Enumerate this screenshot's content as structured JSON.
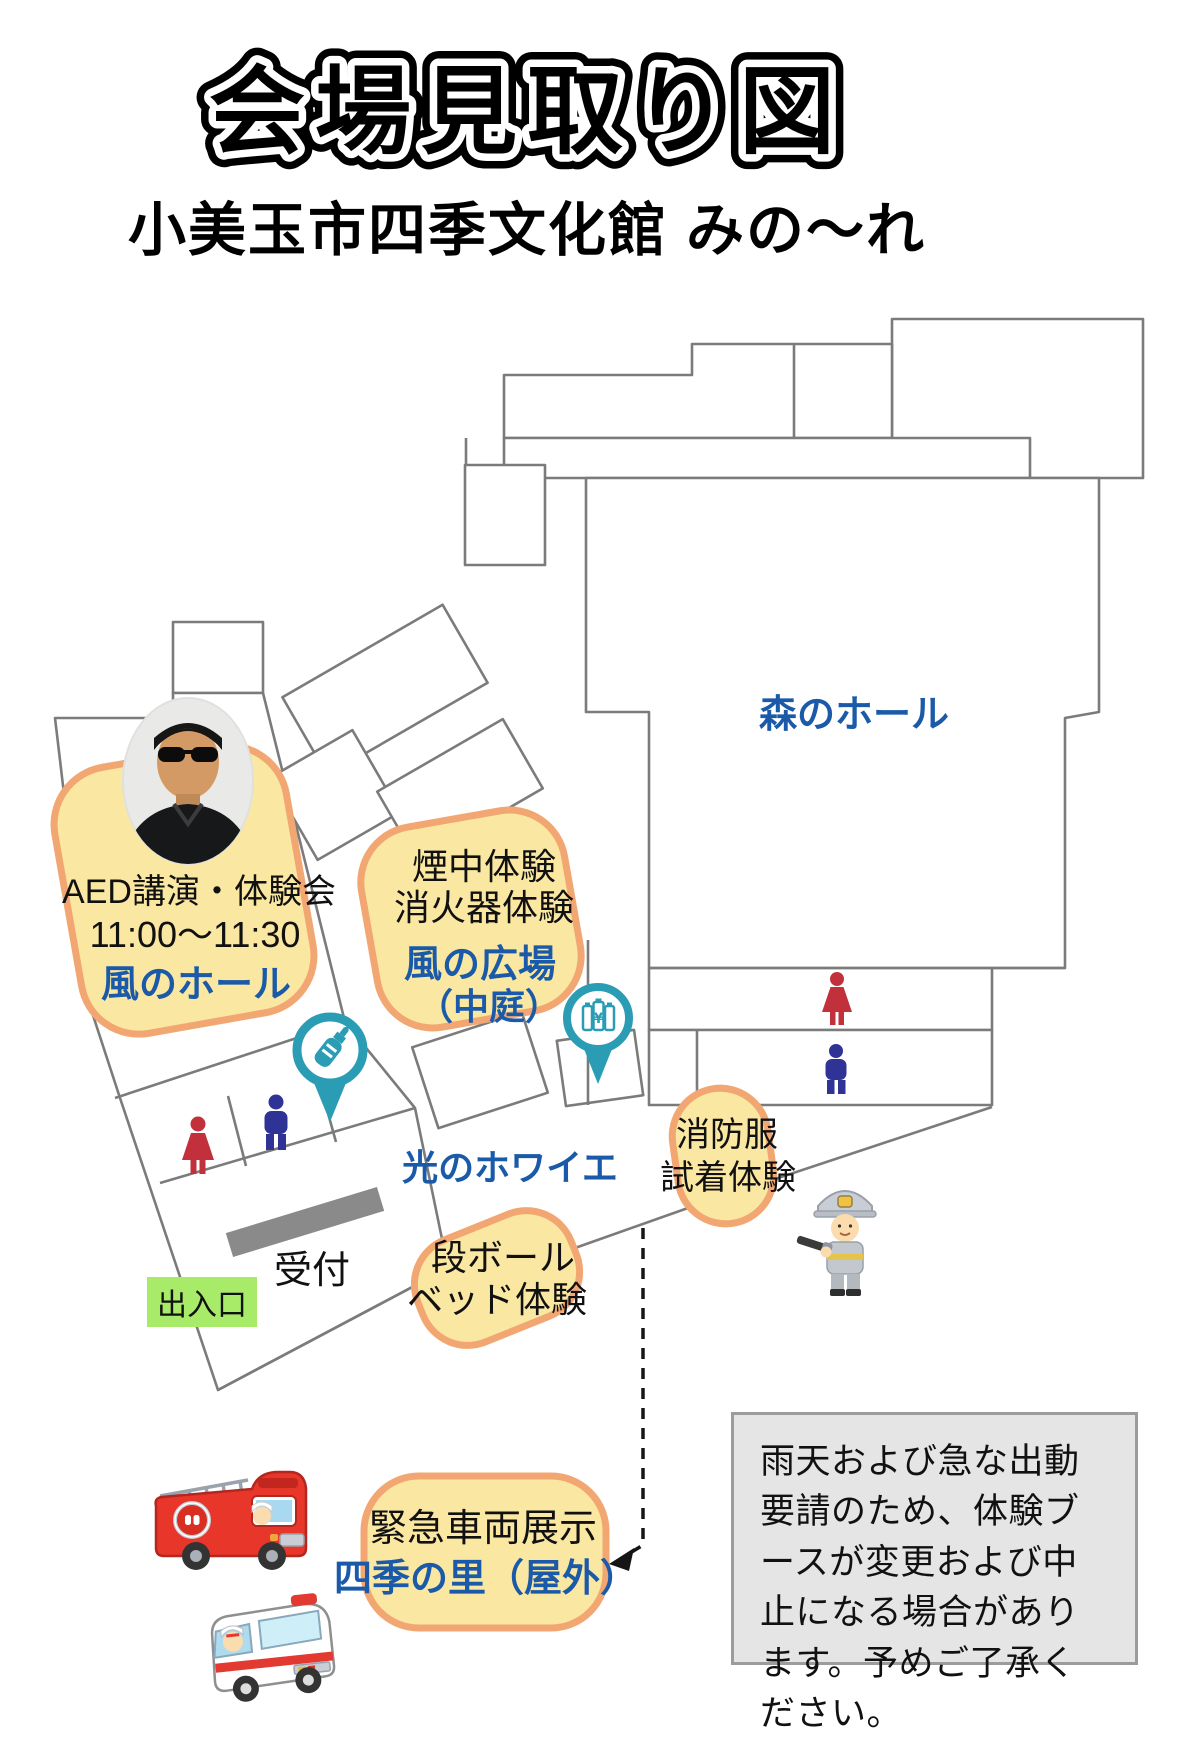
{
  "page": {
    "title": "会場見取り図",
    "subtitle": "小美玉市四季文化館 みの〜れ"
  },
  "map": {
    "forest_hall": "森のホール",
    "foyer": "光のホワイエ",
    "reception": "受付",
    "entrance": "出入口",
    "aed": {
      "line1": "AED講演・体験会",
      "time": "11:00〜11:30",
      "hall": "風のホール"
    },
    "smoke": {
      "line1": "煙中体験",
      "line2": "消火器体験",
      "hall": "風の広場",
      "hall2": "（中庭）"
    },
    "fire_suit": {
      "line1": "消防服",
      "line2": "試着体験"
    },
    "cardboard": {
      "line1": "段ボール",
      "line2": "ベッド体験"
    },
    "vehicles": {
      "line1": "緊急車両展示",
      "hall": "四季の里（屋外）"
    },
    "vending_symbol": "¥"
  },
  "note": {
    "text": "雨天および急な出動要請のため、体験ブースが変更および中止になる場合があります。予めご了承ください。"
  },
  "icons": {
    "baby_bottle_pin": "baby-bottle-pin",
    "vending_pin": "vending-machine-pin",
    "restroom_woman": "woman-restroom",
    "restroom_man": "man-restroom",
    "firefighter": "firefighter-character",
    "fire_truck": "fire-truck",
    "ambulance": "ambulance",
    "speaker_photo": "speaker-portrait",
    "dashed_arrow": "route-arrow"
  },
  "colors": {
    "label_blue": "#1A5AA8",
    "blob_fill": "#FAE7A1",
    "blob_border": "#F2A772",
    "entrance_green": "#A8EB69",
    "pin_teal": "#2A9DB5",
    "woman_red": "#C2303C",
    "man_navy": "#2F3396",
    "outline_gray": "#7B7B7B",
    "desk_gray": "#8A8A8A",
    "note_bg": "#E5E5E5"
  }
}
